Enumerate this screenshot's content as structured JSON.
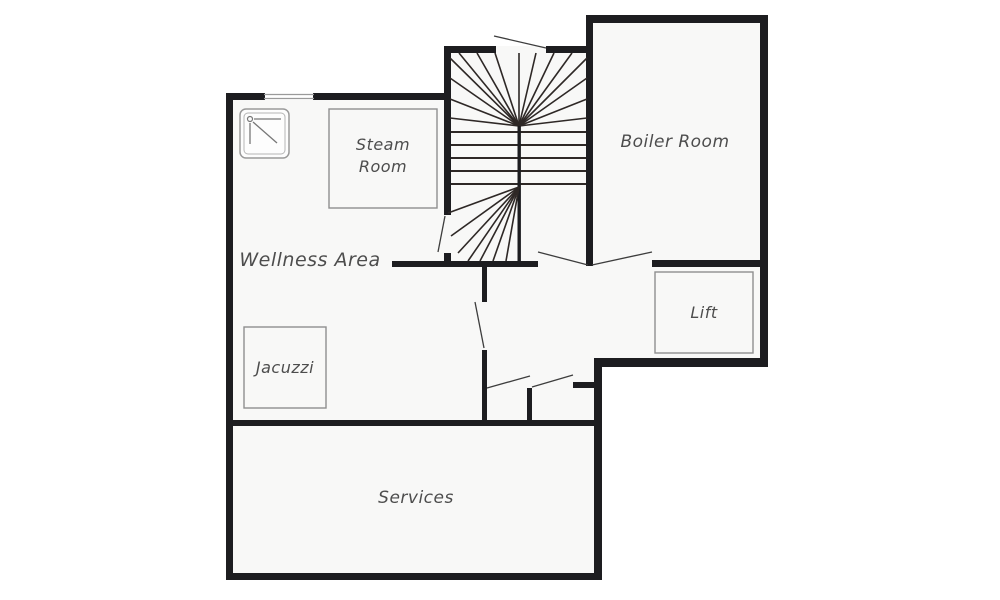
{
  "plan": {
    "title": "Basement floor plan",
    "rooms": {
      "wellness_area": {
        "label": "Wellness Area"
      },
      "steam_room": {
        "label_line1": "Steam",
        "label_line2": "Room"
      },
      "jacuzzi": {
        "label": "Jacuzzi"
      },
      "boiler_room": {
        "label": "Boiler Room"
      },
      "lift": {
        "label": "Lift"
      },
      "services": {
        "label": "Services"
      }
    },
    "features": {
      "shower_icon": "shower-tray",
      "staircase": "winder-staircase",
      "window": "window-top-left-wall",
      "doors": "single-and-double-swing-doors"
    },
    "colors": {
      "wall": "#1d1d20",
      "floor": "#f8f8f7",
      "background": "#ffffff",
      "label": "#4d4d4d",
      "furniture_outline": "#8f8f8f",
      "stair_line": "#2e2826"
    }
  }
}
